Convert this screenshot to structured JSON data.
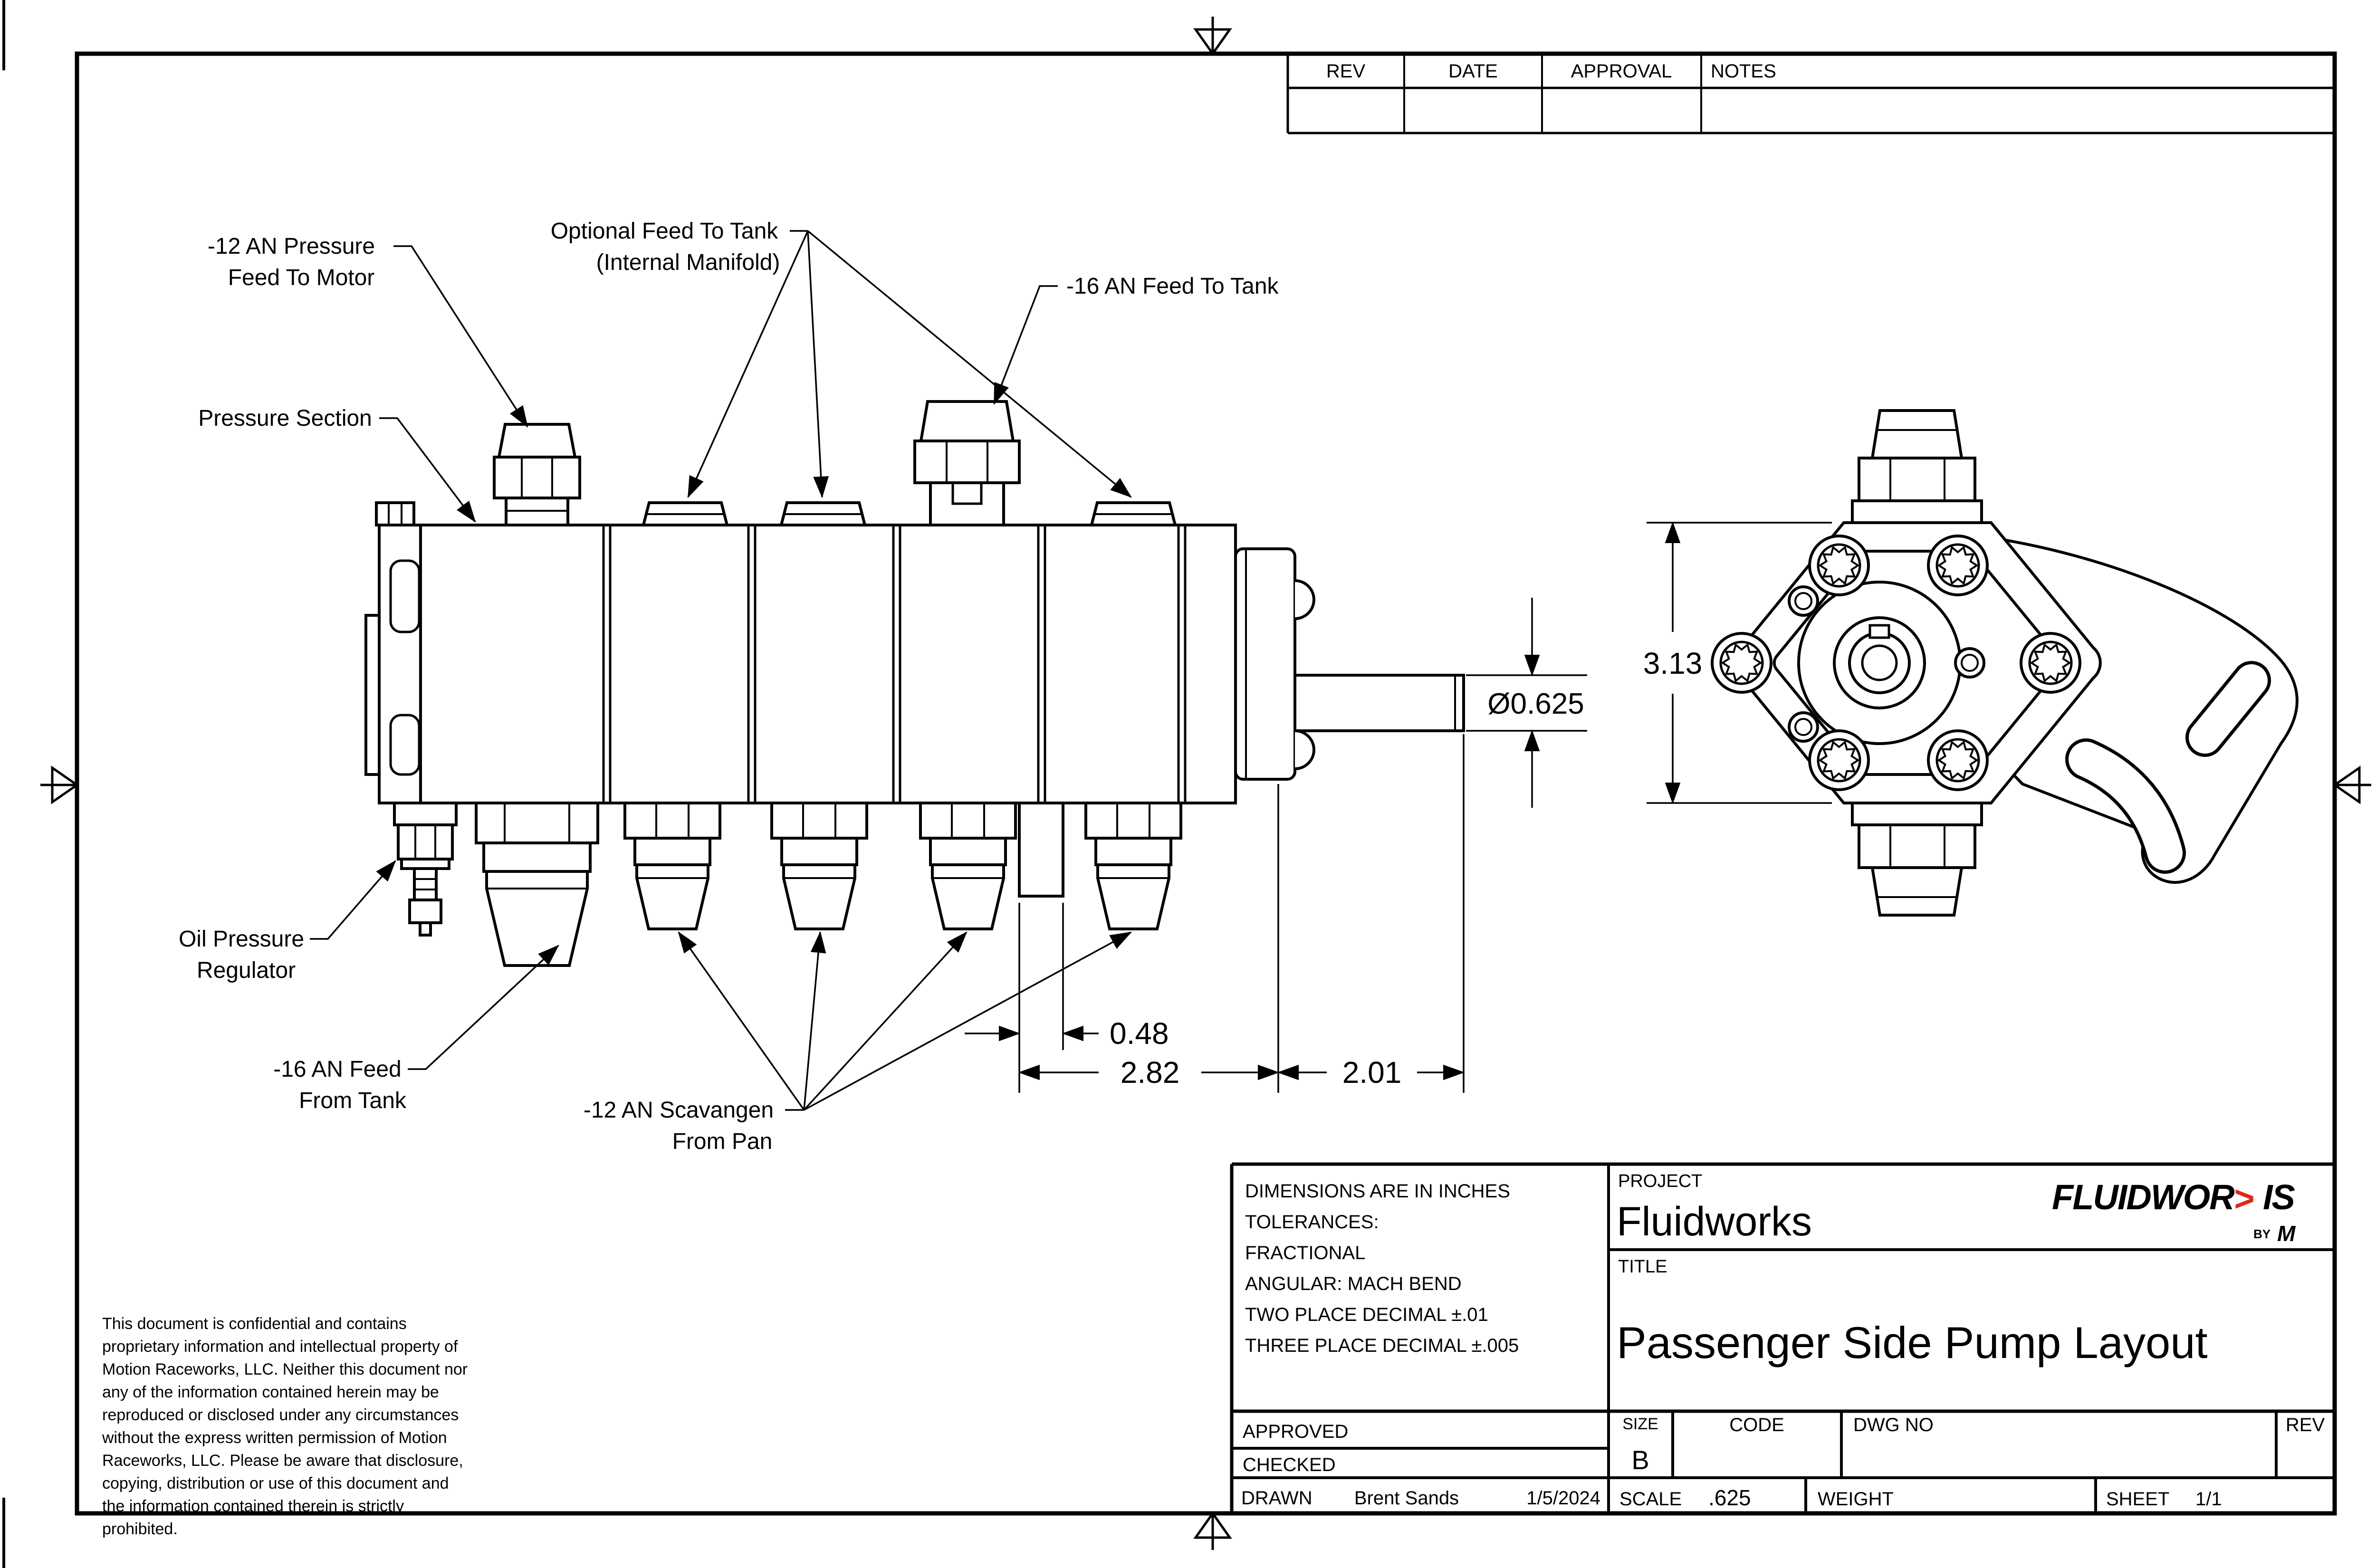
{
  "revision_table": {
    "headers": [
      "REV",
      "DATE",
      "APPROVAL",
      "NOTES"
    ]
  },
  "callouts": {
    "pressure_feed_motor_1": "-12 AN Pressure",
    "pressure_feed_motor_2": "Feed To Motor",
    "optional_feed_tank_1": "Optional Feed To Tank",
    "optional_feed_tank_2": "(Internal Manifold)",
    "feed_to_tank": "-16 AN Feed To Tank",
    "pressure_section": "Pressure Section",
    "oil_pressure_regulator_1": "Oil Pressure",
    "oil_pressure_regulator_2": "Regulator",
    "feed_from_tank_1": "-16 AN Feed",
    "feed_from_tank_2": "From Tank",
    "scavenge_1": "-12 AN Scavangen",
    "scavenge_2": "From Pan"
  },
  "dimensions": {
    "shaft_diameter": "Ø0.625",
    "pump_height": "3.13",
    "tab_width": "0.48",
    "body_length": "2.82",
    "shaft_length": "2.01"
  },
  "confidential_note": "This document is confidential and contains\nproprietary information and intellectual property of\nMotion Raceworks, LLC. Neither this document nor\nany of the information contained herein may be\nreproduced or disclosed under any circumstances\nwithout the express written permission of Motion\nRaceworks, LLC. Please be aware that disclosure,\ncopying, distribution or use of this document and\nthe information contained therein is strictly\nprohibited.",
  "title_block": {
    "tolerance_lines": [
      "DIMENSIONS ARE IN INCHES",
      "TOLERANCES:",
      "FRACTIONAL",
      "ANGULAR: MACH BEND",
      "TWO PLACE DECIMAL ±.01",
      "THREE PLACE DECIMAL ±.005"
    ],
    "project_label": "PROJECT",
    "project_name": "Fluidworks",
    "title_label": "TITLE",
    "drawing_title": "Passenger Side Pump Layout",
    "approved_label": "APPROVED",
    "checked_label": "CHECKED",
    "drawn_label": "DRAWN",
    "drawn_by": "Brent Sands",
    "drawn_date": "1/5/2024",
    "size_label": "SIZE",
    "size_value": "B",
    "code_label": "CODE",
    "dwg_no_label": "DWG NO",
    "rev_label": "REV",
    "scale_label": "SCALE",
    "scale_value": ".625",
    "weight_label": "WEIGHT",
    "sheet_label": "SHEET",
    "sheet_value": "1/1"
  },
  "logo": {
    "word_start": "FLUIDWOR",
    "chevron": ">",
    "word_end": "IS",
    "by_text": "BY",
    "by_mark": "M",
    "accent_color": "#e1251b"
  }
}
